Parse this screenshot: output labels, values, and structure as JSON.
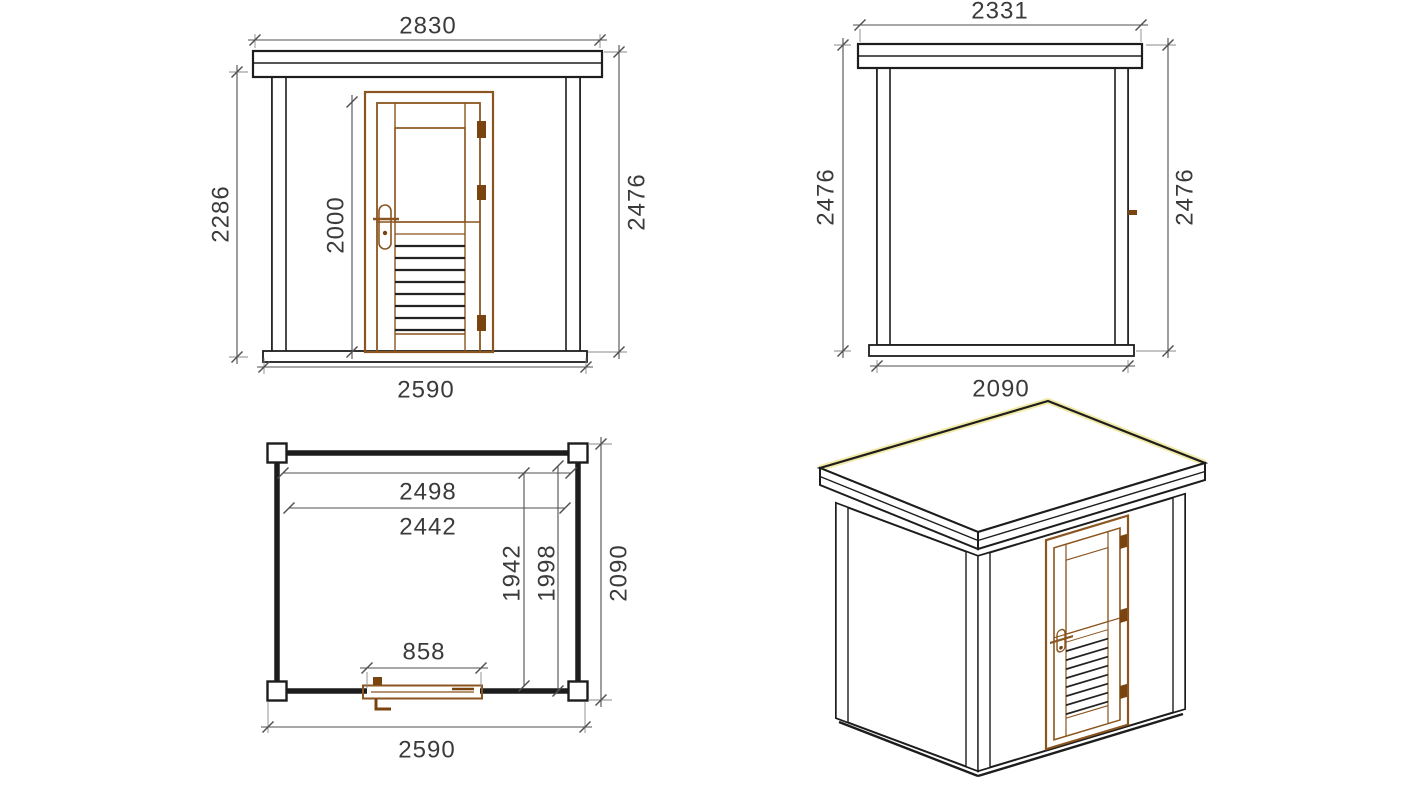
{
  "front_view": {
    "roof_width": "2830",
    "wall_height": "2286",
    "door_height": "2000",
    "total_height": "2476",
    "base_width": "2590"
  },
  "side_view": {
    "roof_depth": "2331",
    "height_left": "2476",
    "height_right": "2476",
    "base_depth": "2090"
  },
  "floor_plan": {
    "inner_width": "2498",
    "inner_width_2": "2442",
    "inner_depth": "1942",
    "inner_depth_2": "1998",
    "outer_depth": "2090",
    "door_opening": "858",
    "outer_width": "2590"
  },
  "colors": {
    "ink": "#1d1d1d",
    "dim": "#4f4f4f",
    "text": "#3b3b3b",
    "wood": "#8a551f",
    "wood_dark": "#7a4410",
    "roof_glow": "#f1e9a6",
    "bg": "#ffffff"
  }
}
